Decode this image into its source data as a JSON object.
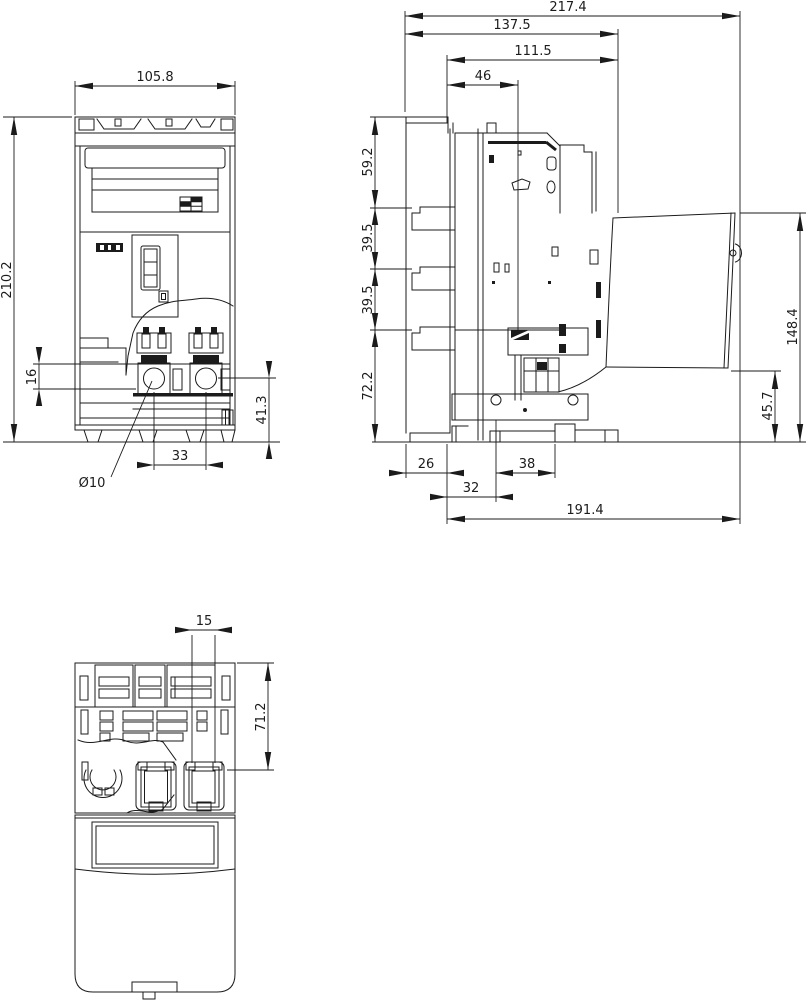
{
  "drawing": {
    "views": {
      "front": {
        "dims": {
          "width": "105.8",
          "height": "210.2",
          "clamp_span": "16",
          "terminal_zone": "41.3",
          "hole_pitch": "33",
          "hole_dia": "Ø10"
        }
      },
      "side": {
        "dims": {
          "overall_depth": "217.4",
          "depth_a": "137.5",
          "depth_b": "111.5",
          "depth_c": "46",
          "seg_top": "59.2",
          "seg_mid1": "39.5",
          "seg_mid2": "39.5",
          "seg_bottom": "72.2",
          "handle_height": "148.4",
          "handle_gap": "45.7",
          "off_a": "26",
          "off_b": "38",
          "off_c": "32",
          "base_depth": "191.4"
        }
      },
      "bottom": {
        "dims": {
          "slot_width": "15",
          "section_depth": "71.2"
        }
      }
    }
  }
}
